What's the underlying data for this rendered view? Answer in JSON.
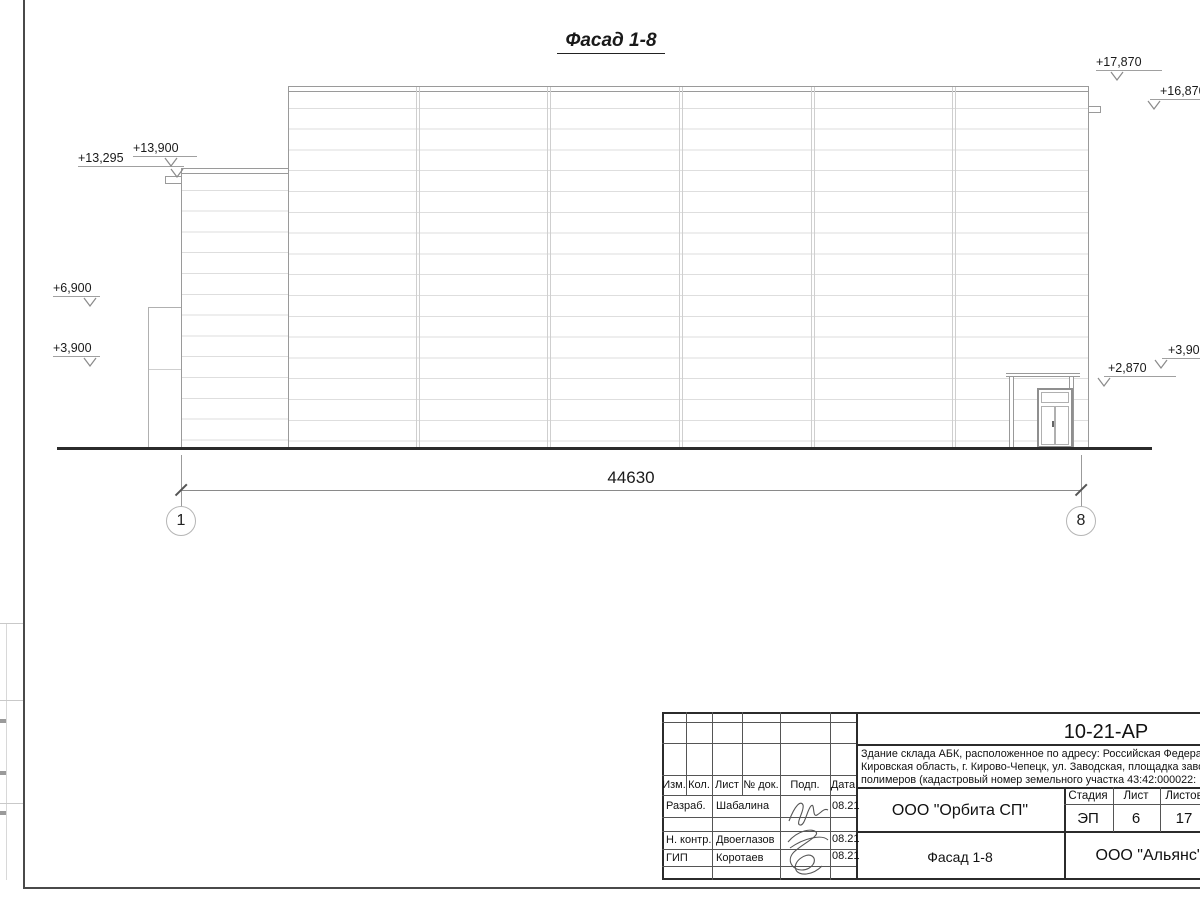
{
  "sheet": {
    "title": "Фасад 1-8",
    "dimension_total": "44630",
    "axis_left": "1",
    "axis_right": "8",
    "marks": {
      "m13295": "+13,295",
      "m13900": "+13,900",
      "m6900": "+6,900",
      "m3900_left": "+3,900",
      "m17870": "+17,870",
      "m16870": "+16,870",
      "m3900_right": "+3,900",
      "m2870": "+2,870"
    }
  },
  "title_block": {
    "doc_code": "10-21-АР",
    "description_line1": "Здание склада АБК, расположенное по адресу: Российская Федерац",
    "description_line2": "Кировская область, г. Кирово-Чепецк, ул. Заводская, площадка заво",
    "description_line3": "полимеров (кадастровый номер земельного участка 43:42:000022:",
    "columns": {
      "izm": "Изм.",
      "kol": "Кол.",
      "list": "Лист",
      "ndok": "№ док.",
      "podp": "Подп.",
      "data": "Дата"
    },
    "rows": [
      {
        "role": "Разраб.",
        "name": "Шабалина",
        "date": "08.21"
      },
      {
        "role": "Н. контр.",
        "name": "Двоеглазов",
        "date": "08.21"
      },
      {
        "role": "ГИП",
        "name": "Коротаев",
        "date": "08.21"
      }
    ],
    "design_org": "ООО \"Орбита СП\"",
    "stage_label": "Стадия",
    "stage_value": "ЭП",
    "sheet_label": "Лист",
    "sheet_value": "6",
    "sheets_label": "Листов",
    "sheets_value": "17",
    "view_title": "Фасад 1-8",
    "client_org": "ООО \"Альянс\""
  }
}
